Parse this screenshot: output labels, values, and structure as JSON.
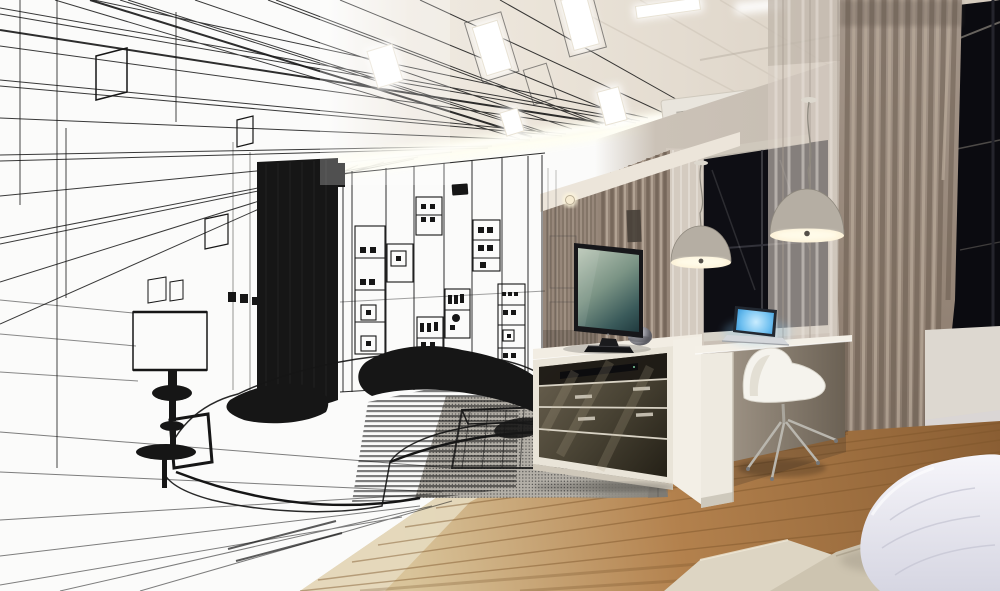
{
  "image": {
    "kind": "architectural-interior-visualization",
    "style": "wireframe-sketch-to-photoreal-render-blend",
    "room": "modern bedroom with tv wall and work desk",
    "text_content": "none"
  },
  "palette": {
    "paper": "#fbfbfa",
    "ink": "#161616",
    "ceiling": "#ebe4d9",
    "ceiling-far": "#d4cabd",
    "cove": "#fffef2",
    "panel": "#ffffff",
    "wall": "#cbc2b7",
    "curtain-main": "#958577",
    "curtain-dark": "#6b5d50",
    "curtain-light": "#b7a898",
    "sheer": "#d5ccc2",
    "slat-wall": "#97877a",
    "window": "#0e0e14",
    "frame": "#d8d3c9",
    "counter": "#f2ede3",
    "cabinet-frame": "#e9e4d8",
    "cabinet-face": "#4a4435",
    "device": "#0c0c0e",
    "tv-bezel": "#17171a",
    "screen-hi": "#b9c6b6",
    "screen-lo": "#223c40",
    "laptop-blue": "#2b8fd6",
    "laptop-glow": "#c9ecff",
    "chair": "#f5f3ed",
    "wood-a": "#d9c49a",
    "wood-b": "#b3814d",
    "wood-c": "#8a5e33",
    "plank": "#7c5429",
    "rug": "#8f8c84",
    "rug-light": "#b3afa7",
    "bed-a": "#ddd5c3",
    "bed-b": "#cdc4b0",
    "pillow-hi": "#f6f5fa",
    "pillow-lo": "#d6d6e2",
    "lamp-dome": "#b5aea3",
    "lamp-rim": "#fdf3da",
    "ac-body": "#e9e5dd",
    "ac-grille": "#b5b1a8"
  },
  "objects": {
    "sketch_side": [
      "perspective-ceiling-lines",
      "wall-picture-frames",
      "black-curtain-block",
      "display-shelving-wall",
      "wireframe-bed",
      "wireframe-table-lamp",
      "wireframe-ottoman",
      "halftone-rug",
      "floor-sketch-lines"
    ],
    "render_side": [
      "slat-ceiling",
      "recessed-light-panels",
      "cove-lighting",
      "cassette-ac-vent",
      "pendant-lamp-left",
      "pendant-lamp-right",
      "night-window-mid",
      "night-window-right",
      "sheer-curtains",
      "curtain-column",
      "tv",
      "media-cabinet",
      "metal-vase",
      "media-player",
      "desk",
      "laptop",
      "white-swivel-chair",
      "wood-floor",
      "shag-rug",
      "bed-platform",
      "white-pillow"
    ]
  }
}
